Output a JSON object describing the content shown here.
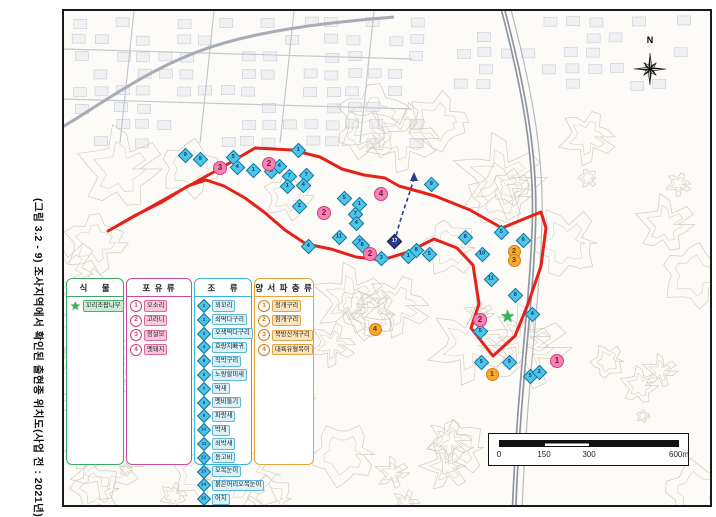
{
  "figure_title": "(그림 3.2 - 9) 조사지역에서 확인된 출현종 위치도(사업 전 : 2021년)",
  "legend": {
    "plant": {
      "header": "식    물",
      "items": [
        {
          "marker": "star",
          "label": "꼬리조팝나무"
        }
      ]
    },
    "mammal": {
      "header": "포 유 류",
      "items": [
        {
          "no": "1",
          "label": "오소리"
        },
        {
          "no": "2",
          "label": "고라니"
        },
        {
          "no": "3",
          "label": "청설모"
        },
        {
          "no": "4",
          "label": "멧돼지"
        }
      ]
    },
    "bird": {
      "header": "조    류",
      "items": [
        {
          "no": "1",
          "label": "꾀꼬리"
        },
        {
          "no": "2",
          "label": "쇠딱다구리"
        },
        {
          "no": "3",
          "label": "오색딱다구리"
        },
        {
          "no": "4",
          "label": "호랑지빠귀"
        },
        {
          "no": "5",
          "label": "직박구리"
        },
        {
          "no": "6",
          "label": "노랑할미새"
        },
        {
          "no": "7",
          "label": "딱새"
        },
        {
          "no": "8",
          "label": "멧비둘기"
        },
        {
          "no": "9",
          "label": "파랑새"
        },
        {
          "no": "10",
          "label": "박새"
        },
        {
          "no": "11",
          "label": "쇠박새"
        },
        {
          "no": "12",
          "label": "동고비"
        },
        {
          "no": "13",
          "label": "오목눈이"
        },
        {
          "no": "14",
          "label": "붉은머리오목눈이"
        },
        {
          "no": "15",
          "label": "어치"
        },
        {
          "no": "16",
          "label": "큰부리까마귀"
        },
        {
          "no": "17",
          "label": "새호리기",
          "highlight": true
        }
      ]
    },
    "herp": {
      "header": "양 서 파 충 류",
      "items": [
        {
          "no": "1",
          "label": "청개구리"
        },
        {
          "no": "2",
          "label": "참개구리"
        },
        {
          "no": "3",
          "label": "북방산개구리"
        },
        {
          "no": "4",
          "label": "대륙유혈목이"
        }
      ]
    }
  },
  "map": {
    "north_label": "N",
    "scalebar": {
      "labels": [
        "0",
        "150",
        "300",
        "600m"
      ]
    },
    "boundary": [
      [
        106,
        229
      ],
      [
        163,
        197
      ],
      [
        219,
        166
      ],
      [
        253,
        146
      ],
      [
        290,
        148
      ],
      [
        318,
        155
      ],
      [
        340,
        167
      ],
      [
        362,
        173
      ],
      [
        383,
        176
      ],
      [
        397,
        184
      ],
      [
        433,
        194
      ],
      [
        468,
        208
      ],
      [
        500,
        226
      ],
      [
        539,
        210
      ],
      [
        544,
        226
      ],
      [
        539,
        264
      ],
      [
        526,
        302
      ],
      [
        513,
        334
      ],
      [
        491,
        354
      ],
      [
        469,
        326
      ],
      [
        477,
        302
      ],
      [
        471,
        263
      ],
      [
        455,
        246
      ],
      [
        432,
        237
      ],
      [
        406,
        250
      ],
      [
        380,
        258
      ],
      [
        354,
        255
      ],
      [
        329,
        247
      ],
      [
        304,
        242
      ],
      [
        283,
        228
      ],
      [
        262,
        210
      ],
      [
        243,
        196
      ],
      [
        222,
        184
      ],
      [
        204,
        178
      ],
      [
        186,
        184
      ],
      [
        160,
        200
      ],
      [
        132,
        214
      ]
    ],
    "flight_path": {
      "from": [
        393,
        240
      ],
      "to": [
        412,
        176
      ]
    },
    "markers": {
      "bird": [
        {
          "x": 184,
          "y": 154,
          "n": "9"
        },
        {
          "x": 199,
          "y": 158,
          "n": "8"
        },
        {
          "x": 232,
          "y": 156,
          "n": "5"
        },
        {
          "x": 236,
          "y": 166,
          "n": "4"
        },
        {
          "x": 252,
          "y": 169,
          "n": "1"
        },
        {
          "x": 270,
          "y": 170,
          "n": "5"
        },
        {
          "x": 278,
          "y": 165,
          "n": "4"
        },
        {
          "x": 288,
          "y": 175,
          "n": "7"
        },
        {
          "x": 305,
          "y": 174,
          "n": "7"
        },
        {
          "x": 286,
          "y": 185,
          "n": "1"
        },
        {
          "x": 302,
          "y": 184,
          "n": "4"
        },
        {
          "x": 298,
          "y": 205,
          "n": "2"
        },
        {
          "x": 297,
          "y": 149,
          "n": "1"
        },
        {
          "x": 343,
          "y": 197,
          "n": "5"
        },
        {
          "x": 358,
          "y": 203,
          "n": "1"
        },
        {
          "x": 354,
          "y": 213,
          "n": "7"
        },
        {
          "x": 355,
          "y": 222,
          "n": "4"
        },
        {
          "x": 338,
          "y": 236,
          "n": "11"
        },
        {
          "x": 358,
          "y": 241,
          "n": "1"
        },
        {
          "x": 361,
          "y": 244,
          "n": "8"
        },
        {
          "x": 380,
          "y": 257,
          "n": "3"
        },
        {
          "x": 307,
          "y": 245,
          "n": "4"
        },
        {
          "x": 407,
          "y": 255,
          "n": "1"
        },
        {
          "x": 415,
          "y": 249,
          "n": "8"
        },
        {
          "x": 428,
          "y": 253,
          "n": "5"
        },
        {
          "x": 430,
          "y": 183,
          "n": "9"
        },
        {
          "x": 464,
          "y": 236,
          "n": "8"
        },
        {
          "x": 500,
          "y": 231,
          "n": "5"
        },
        {
          "x": 522,
          "y": 239,
          "n": "6"
        },
        {
          "x": 481,
          "y": 253,
          "n": "10"
        },
        {
          "x": 490,
          "y": 278,
          "n": "11"
        },
        {
          "x": 514,
          "y": 294,
          "n": "8"
        },
        {
          "x": 531,
          "y": 313,
          "n": "4"
        },
        {
          "x": 479,
          "y": 330,
          "n": "5"
        },
        {
          "x": 480,
          "y": 361,
          "n": "5"
        },
        {
          "x": 508,
          "y": 361,
          "n": "9"
        },
        {
          "x": 529,
          "y": 375,
          "n": "5"
        },
        {
          "x": 538,
          "y": 371,
          "n": "2"
        },
        {
          "x": 393,
          "y": 240,
          "n": "17",
          "special": true
        }
      ],
      "mammal": [
        {
          "x": 218,
          "y": 166,
          "n": "3"
        },
        {
          "x": 267,
          "y": 162,
          "n": "2"
        },
        {
          "x": 322,
          "y": 211,
          "n": "2"
        },
        {
          "x": 379,
          "y": 192,
          "n": "4"
        },
        {
          "x": 368,
          "y": 252,
          "n": "2"
        },
        {
          "x": 478,
          "y": 318,
          "n": "2"
        },
        {
          "x": 555,
          "y": 359,
          "n": "1"
        }
      ],
      "herp": [
        {
          "x": 512,
          "y": 249,
          "n": "2"
        },
        {
          "x": 512,
          "y": 258,
          "n": "3"
        },
        {
          "x": 490,
          "y": 372,
          "n": "1"
        },
        {
          "x": 373,
          "y": 327,
          "n": "4"
        }
      ],
      "plant": [
        {
          "x": 507,
          "y": 316
        }
      ]
    }
  },
  "colors": {
    "boundary": "#e32219",
    "bird_marker": "#4cc6e6",
    "bird_special": "#2b3a8c",
    "mammal_marker": "#f584b4",
    "herp_marker": "#f6ac33",
    "plant_marker": "#35b457"
  }
}
